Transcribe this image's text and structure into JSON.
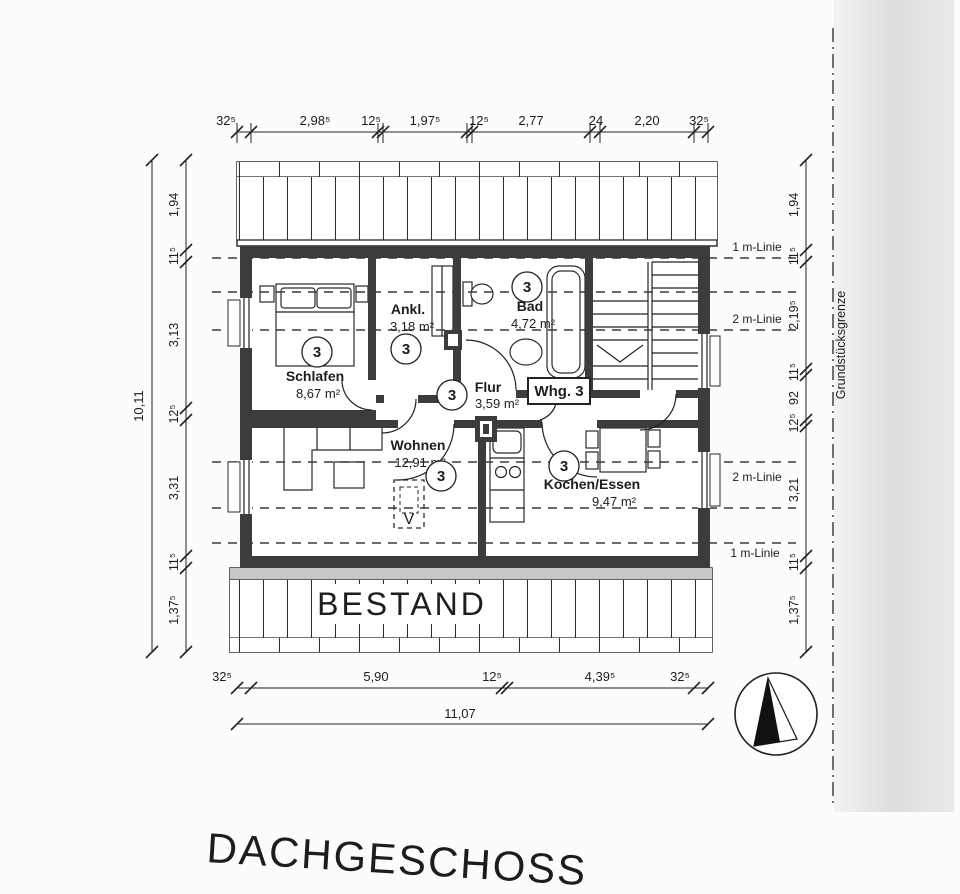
{
  "page": {
    "title": "DACHGESCHOSS",
    "bestand_label": "BESTAND",
    "boundary_label": "Grundstücksgrenze"
  },
  "plan": {
    "apartment_label": "Whg. 3",
    "unit_number": "3",
    "skylight_mark": "V",
    "rooms": [
      {
        "name": "Schlafen",
        "area": "8,67 m²"
      },
      {
        "name": "Ankl.",
        "area": "3,18 m²"
      },
      {
        "name": "Bad",
        "area": "4,72 m²"
      },
      {
        "name": "Flur",
        "area": "3,59 m²"
      },
      {
        "name": "Wohnen",
        "area": "12,91 m²"
      },
      {
        "name": "Kochen/Essen",
        "area": "9,47 m²"
      }
    ],
    "height_lines": [
      "1 m-Linie",
      "2 m-Linie",
      "2 m-Linie",
      "1 m-Linie"
    ]
  },
  "dimensions": {
    "top": [
      "32⁵",
      "2,98⁵",
      "12⁵",
      "1,97⁵",
      "12⁵",
      "2,77",
      "24",
      "2,20",
      "32⁵"
    ],
    "bottom": [
      "32⁵",
      "5,90",
      "12⁵",
      "4,39⁵",
      "32⁵"
    ],
    "bottom_total": "11,07",
    "left_total": "10,11",
    "left": [
      "1,94",
      "11⁵",
      "3,13",
      "12⁵",
      "3,31",
      "11⁵",
      "1,37⁵"
    ],
    "right": [
      "1,94",
      "11⁵",
      "2,19⁵",
      "11⁵",
      "92",
      "12⁵",
      "3,21",
      "11⁵",
      "1,37⁵"
    ]
  },
  "colors": {
    "wall": "#3c3c3c",
    "line": "#222222",
    "scan_edge": "#dddddc"
  }
}
